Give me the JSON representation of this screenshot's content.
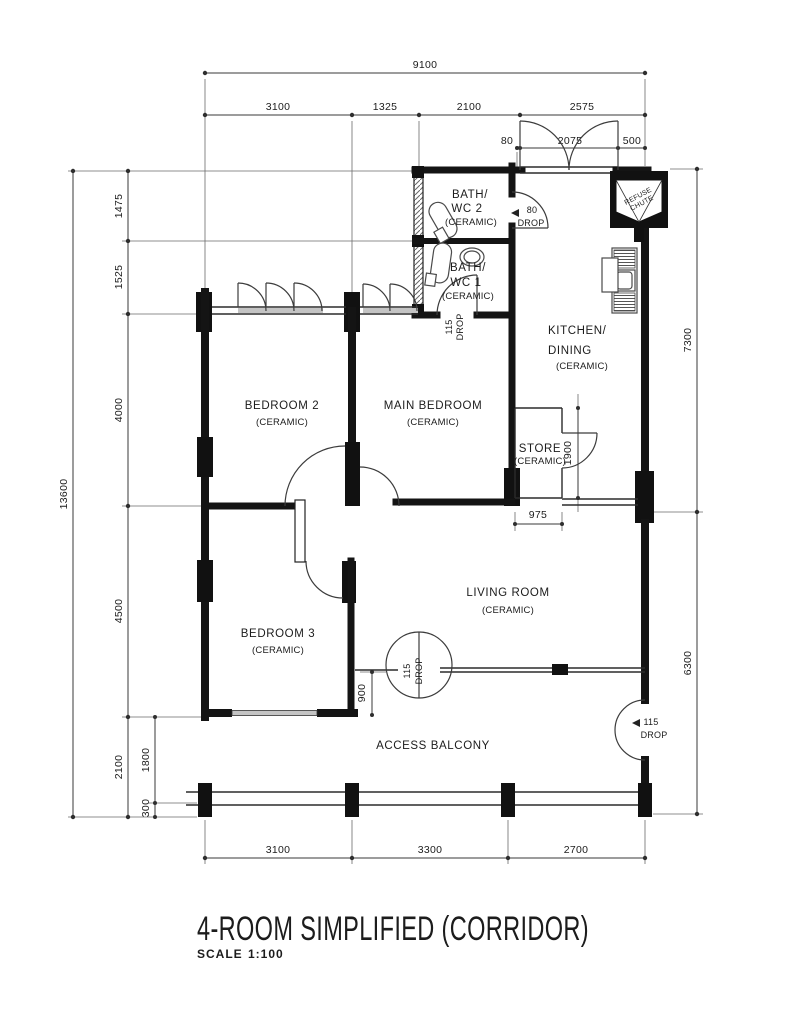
{
  "title": {
    "text": "4-ROOM SIMPLIFIED (CORRIDOR)",
    "scale_label": "SCALE",
    "scale_value": "1:100"
  },
  "colors": {
    "ink": "#1c1c1c",
    "paper": "#ffffff"
  },
  "dims": {
    "top": {
      "overall": "9100",
      "row": [
        "3100",
        "1325",
        "2100",
        "2575"
      ],
      "entrance": [
        "80",
        "2075",
        "500"
      ]
    },
    "left": {
      "overall": "13600",
      "row": [
        "1475",
        "1525",
        "4000",
        "4500",
        "2100"
      ],
      "inner": [
        "1800",
        "300"
      ]
    },
    "right": [
      "7300",
      "6300"
    ],
    "bottom": [
      "3100",
      "3300",
      "2700"
    ],
    "interior": {
      "store_depth": "1900",
      "store_width": "975",
      "bedroom3_offset": "900"
    }
  },
  "drops": {
    "v80": "80",
    "v115": "115",
    "word": "DROP"
  },
  "rooms": {
    "bath2": [
      "BATH/",
      "WC 2",
      "(CERAMIC)"
    ],
    "bath1": [
      "BATH/",
      "WC 1",
      "(CERAMIC)"
    ],
    "kitchen": [
      "KITCHEN/",
      "DINING",
      "(CERAMIC)"
    ],
    "bedroom2": [
      "BEDROOM 2",
      "(CERAMIC)"
    ],
    "main_bedroom": [
      "MAIN BEDROOM",
      "(CERAMIC)"
    ],
    "store": [
      "STORE",
      "(CERAMIC)"
    ],
    "bedroom3": [
      "BEDROOM 3",
      "(CERAMIC)"
    ],
    "living": [
      "LIVING ROOM",
      "(CERAMIC)"
    ],
    "balcony": "ACCESS BALCONY",
    "refuse_chute": [
      "REFUSE",
      "CHUTE"
    ]
  }
}
